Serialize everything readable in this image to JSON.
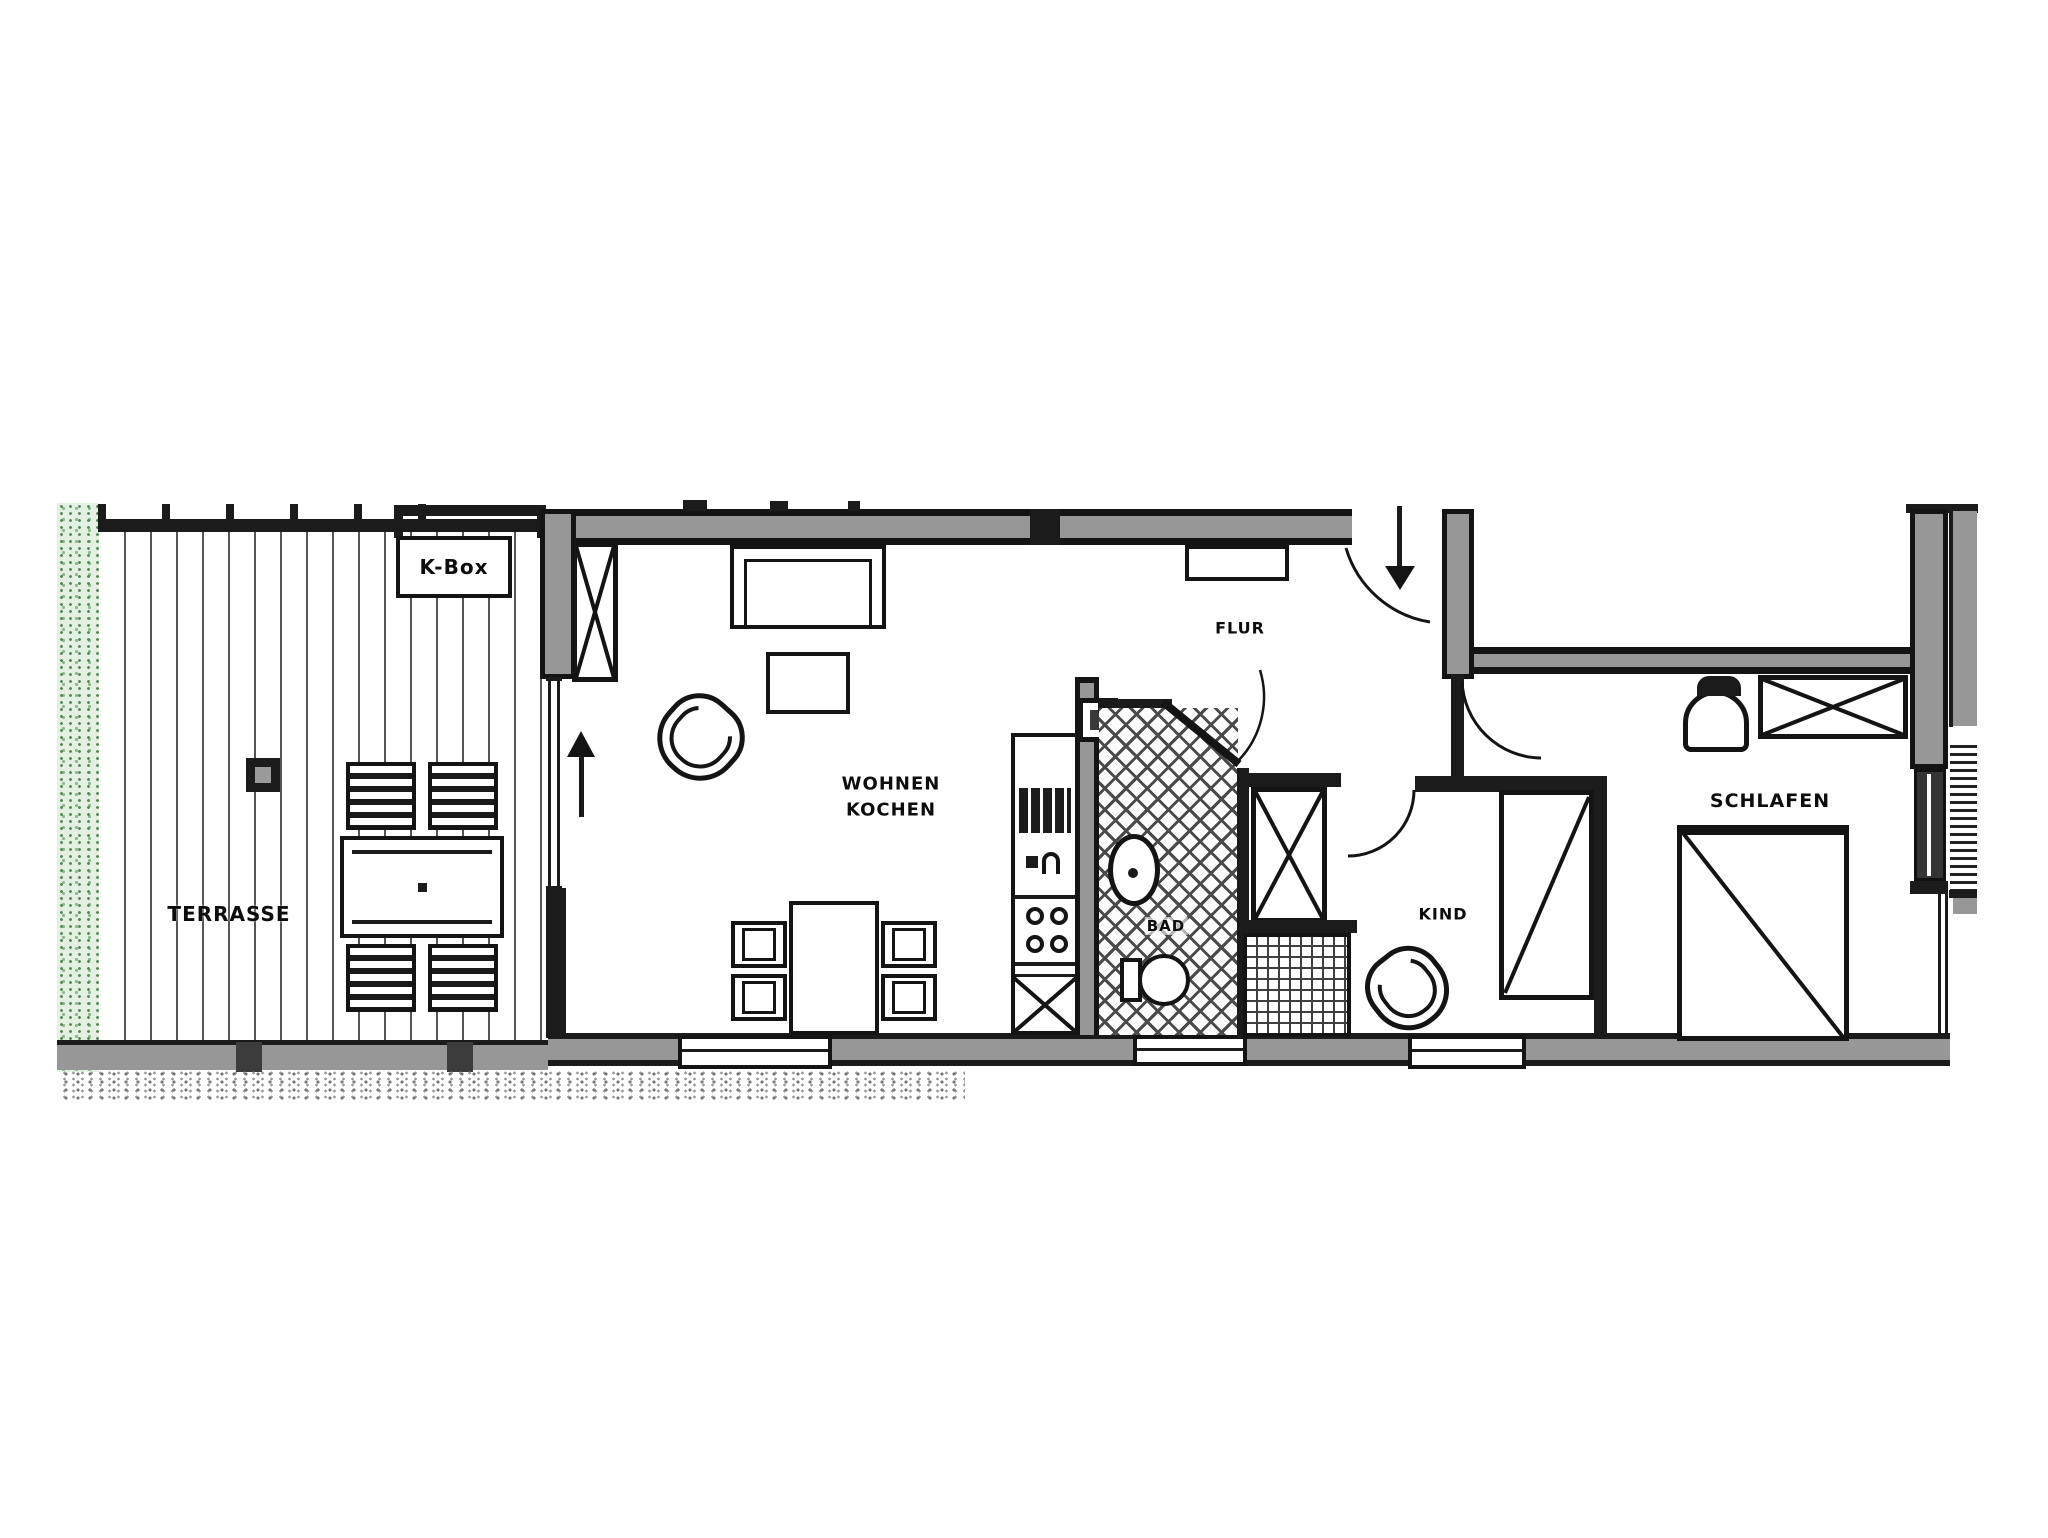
{
  "meta": {
    "type": "apartment-floor-plan",
    "language": "de"
  },
  "colors": {
    "wall_gray": "#979797",
    "line_black": "#141414",
    "hedge_green": "#8cb98c",
    "paper_white": "#ffffff"
  },
  "rooms": {
    "terrace": {
      "label": "TERRASSE"
    },
    "kbox": {
      "label": "K-Box"
    },
    "living": {
      "label_line1": "WOHNEN",
      "label_line2": "KOCHEN"
    },
    "hall": {
      "label": "FLUR"
    },
    "bath": {
      "label": "BAD"
    },
    "child": {
      "label": "KIND"
    },
    "bedroom": {
      "label": "SCHLAFEN"
    }
  },
  "icons": {
    "terrace": [
      "terrace-table-icon",
      "terrace-chair-icon",
      "floor-drain-icon",
      "hedge",
      "decking"
    ],
    "living": [
      "sofa-icon",
      "coffee-table-icon",
      "armchair-icon",
      "dining-table-icon",
      "dining-chair-icon",
      "direction-arrow-icon",
      "shaft-x-icon"
    ],
    "kitchen": [
      "oven-icon",
      "sink-icon",
      "stove-burners-icon",
      "base-cabinet-x-icon"
    ],
    "bath": [
      "washbasin-icon",
      "toilet-icon",
      "shower-icon",
      "tile-crosshatch"
    ],
    "hall": [
      "entrance-arrow-icon",
      "door-swing-arc",
      "wardrobe-x-icon",
      "sideboard-icon"
    ],
    "child": [
      "bed-icon",
      "armchair-icon"
    ],
    "bedroom": [
      "double-bed-icon",
      "wardrobe-x-icon",
      "bassinet-icon",
      "window-shutter-hatch"
    ]
  }
}
